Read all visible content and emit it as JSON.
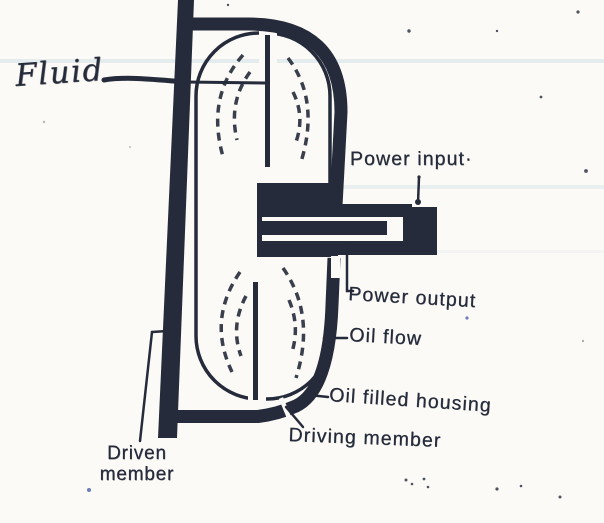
{
  "figure": {
    "title": "Fluid coupling cross-section diagram (scanned textbook figure)",
    "labels": {
      "fluid": "Fluid",
      "power_input": "Power input·",
      "power_output": "Power output",
      "oil_flow": "Oil flow",
      "oil_filled_housing": "Oil filled housing",
      "driving_member": "Driving member",
      "driven_member_line1": "Driven",
      "driven_member_line2": "member"
    },
    "colors": {
      "ink": "#252b3a",
      "paper": "#fbfaf6",
      "streak": "#b9d2dc",
      "blue_speck": "#4a5fa8"
    }
  }
}
